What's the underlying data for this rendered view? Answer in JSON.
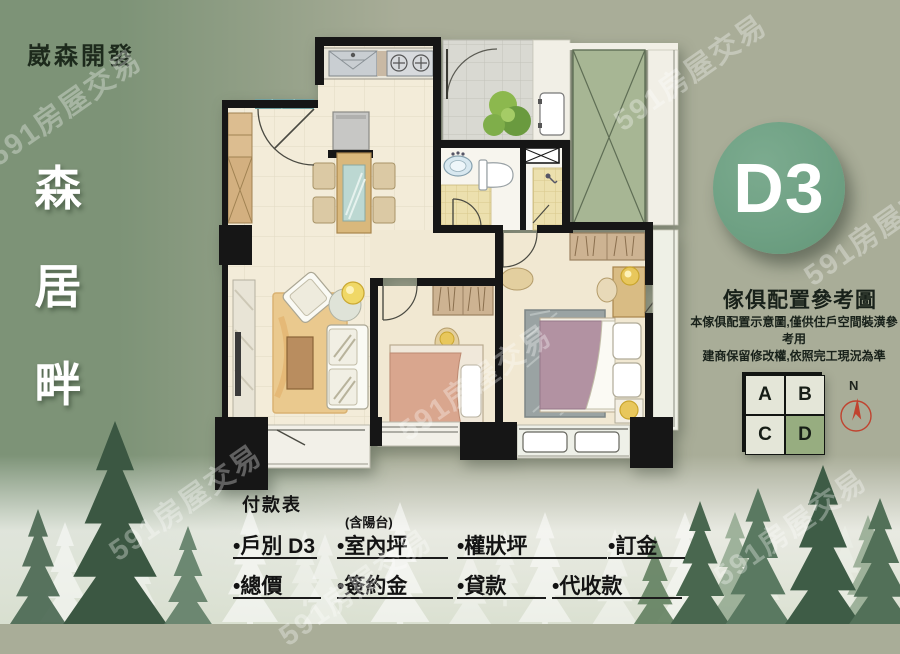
{
  "watermark": {
    "text": "591房屋交易"
  },
  "branding": {
    "developer": "崴森開發",
    "project_chars": [
      "森",
      "居",
      "畔"
    ]
  },
  "unit_badge": {
    "label": "D3"
  },
  "furniture_note": {
    "title": "傢俱配置參考圖",
    "line1": "本傢俱配置示意圖,僅供住戶空間裝潢參考用",
    "line2": "建商保留修改權,依照完工現況為準"
  },
  "unit_grid": {
    "cells": [
      {
        "label": "A"
      },
      {
        "label": "B"
      },
      {
        "label": "C"
      },
      {
        "label": "D"
      }
    ],
    "selected": "D"
  },
  "compass": {
    "label": "N"
  },
  "payment": {
    "title": "付款表",
    "rows": [
      [
        {
          "label": "•戶別 D3",
          "note": ""
        },
        {
          "label": "•室內坪",
          "note": "(含陽台)"
        },
        {
          "label": "•權狀坪",
          "note": ""
        },
        {
          "label": "•訂金",
          "note": ""
        }
      ],
      [
        {
          "label": "•總價"
        },
        {
          "label": "•簽約金"
        },
        {
          "label": "•貸款"
        },
        {
          "label": "•代收款"
        }
      ]
    ]
  },
  "colors": {
    "background": "#a9ad98",
    "panel_green": "#7d9377",
    "badge_green": "#6fa184",
    "grid_selected": "#97ad80",
    "wall_black": "#161616",
    "floor_cream": "#f3ecd9",
    "compass_red": "#c0432f"
  }
}
